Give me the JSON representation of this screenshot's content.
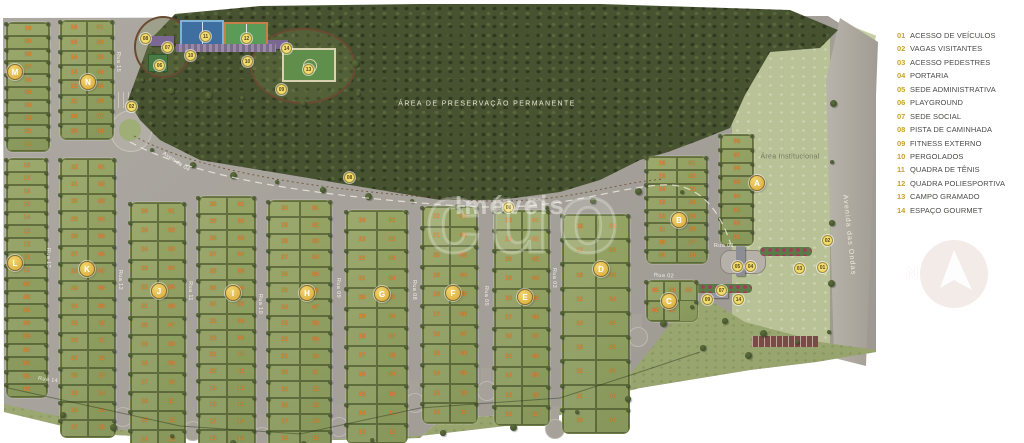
{
  "legend": {
    "items": [
      {
        "num": "01",
        "label": "ACESSO DE VEÍCULOS"
      },
      {
        "num": "02",
        "label": "VAGAS VISITANTES"
      },
      {
        "num": "03",
        "label": "ACESSO PEDESTRES"
      },
      {
        "num": "04",
        "label": "PORTARIA"
      },
      {
        "num": "05",
        "label": "SEDE ADMINISTRATIVA"
      },
      {
        "num": "06",
        "label": "PLAYGROUND"
      },
      {
        "num": "07",
        "label": "SEDE SOCIAL"
      },
      {
        "num": "08",
        "label": "PISTA DE CAMINHADA"
      },
      {
        "num": "09",
        "label": "FITNESS EXTERNO"
      },
      {
        "num": "10",
        "label": "PERGOLADOS"
      },
      {
        "num": "11",
        "label": "QUADRA DE TÊNIS"
      },
      {
        "num": "12",
        "label": "QUADRA POLIESPORTIVA"
      },
      {
        "num": "13",
        "label": "CAMPO GRAMADO"
      },
      {
        "num": "14",
        "label": "ESPAÇO GOURMET"
      }
    ]
  },
  "map": {
    "areas": {
      "preservation": "ÁREA DE PRESERVAÇÃO PERMANENTE",
      "institutional": "Área Institucional"
    },
    "streets": [
      {
        "name": "Avenida das Ondas",
        "x": 849,
        "y": 235,
        "rot": 84,
        "size": "lg"
      },
      {
        "name": "Avenida 04",
        "x": 176,
        "y": 162,
        "rot": 33,
        "size": "sm"
      },
      {
        "name": "Rua 01",
        "x": 724,
        "y": 246,
        "rot": 0,
        "size": "sm"
      },
      {
        "name": "Rua 02",
        "x": 664,
        "y": 276,
        "rot": 3,
        "size": "sm"
      },
      {
        "name": "Rua 03",
        "x": 554,
        "y": 278,
        "rot": 90,
        "size": "sm"
      },
      {
        "name": "Rua 05",
        "x": 486,
        "y": 296,
        "rot": 90,
        "size": "sm"
      },
      {
        "name": "Rua 08",
        "x": 414,
        "y": 290,
        "rot": 90,
        "size": "sm"
      },
      {
        "name": "Rua 09",
        "x": 338,
        "y": 288,
        "rot": 90,
        "size": "sm"
      },
      {
        "name": "Rua 10",
        "x": 260,
        "y": 304,
        "rot": 90,
        "size": "sm"
      },
      {
        "name": "Rua 11",
        "x": 190,
        "y": 291,
        "rot": 90,
        "size": "sm"
      },
      {
        "name": "Rua 12",
        "x": 120,
        "y": 280,
        "rot": 90,
        "size": "sm"
      },
      {
        "name": "Rua 13",
        "x": 48,
        "y": 258,
        "rot": 90,
        "size": "sm"
      },
      {
        "name": "Rua 14",
        "x": 48,
        "y": 380,
        "rot": 8,
        "size": "sm"
      },
      {
        "name": "Rua 15",
        "x": 118,
        "y": 62,
        "rot": 90,
        "size": "sm"
      }
    ],
    "blocks": [
      {
        "letter": "M",
        "x": 6,
        "y": 22,
        "w": 42,
        "h": 128,
        "cols": 1,
        "lots": 10,
        "bx": 14,
        "by": 71
      },
      {
        "letter": "N",
        "x": 60,
        "y": 20,
        "w": 52,
        "h": 118,
        "cols": 2,
        "lots": 16,
        "bx": 87,
        "by": 81
      },
      {
        "letter": "L",
        "x": 6,
        "y": 158,
        "w": 40,
        "h": 238,
        "cols": 1,
        "lots": 18,
        "bx": 14,
        "by": 262
      },
      {
        "letter": "K",
        "x": 60,
        "y": 158,
        "w": 54,
        "h": 278,
        "cols": 2,
        "lots": 32,
        "bx": 86,
        "by": 268
      },
      {
        "letter": "J",
        "x": 130,
        "y": 202,
        "w": 54,
        "h": 246,
        "cols": 2,
        "lots": 26,
        "bx": 158,
        "by": 290
      },
      {
        "letter": "I",
        "x": 198,
        "y": 196,
        "w": 56,
        "h": 250,
        "cols": 2,
        "lots": 30,
        "bx": 232,
        "by": 292
      },
      {
        "letter": "H",
        "x": 268,
        "y": 200,
        "w": 62,
        "h": 246,
        "cols": 2,
        "lots": 30,
        "bx": 306,
        "by": 292
      },
      {
        "letter": "G",
        "x": 346,
        "y": 210,
        "w": 60,
        "h": 232,
        "cols": 2,
        "lots": 24,
        "bx": 381,
        "by": 293
      },
      {
        "letter": "F",
        "x": 422,
        "y": 206,
        "w": 54,
        "h": 216,
        "cols": 2,
        "lots": 22,
        "bx": 452,
        "by": 292
      },
      {
        "letter": "E",
        "x": 494,
        "y": 210,
        "w": 54,
        "h": 214,
        "cols": 2,
        "lots": 22,
        "bx": 524,
        "by": 296
      },
      {
        "letter": "D",
        "x": 562,
        "y": 214,
        "w": 66,
        "h": 218,
        "cols": 2,
        "lots": 18,
        "bx": 600,
        "by": 268
      },
      {
        "letter": "C",
        "x": 646,
        "y": 280,
        "w": 50,
        "h": 40,
        "cols": 3,
        "lots": 5,
        "bx": 668,
        "by": 300
      },
      {
        "letter": "B",
        "x": 646,
        "y": 156,
        "w": 60,
        "h": 106,
        "cols": 2,
        "lots": 16,
        "bx": 678,
        "by": 219
      },
      {
        "letter": "A",
        "x": 720,
        "y": 134,
        "w": 32,
        "h": 110,
        "cols": 1,
        "lots": 8,
        "bx": 756,
        "by": 182
      }
    ],
    "markers": [
      {
        "num": "08",
        "x": 140,
        "y": 33
      },
      {
        "num": "07",
        "x": 162,
        "y": 42
      },
      {
        "num": "06",
        "x": 154,
        "y": 60
      },
      {
        "num": "10",
        "x": 185,
        "y": 50
      },
      {
        "num": "11",
        "x": 200,
        "y": 31
      },
      {
        "num": "12",
        "x": 241,
        "y": 33
      },
      {
        "num": "10",
        "x": 242,
        "y": 56
      },
      {
        "num": "14",
        "x": 281,
        "y": 43
      },
      {
        "num": "13",
        "x": 303,
        "y": 64
      },
      {
        "num": "09",
        "x": 276,
        "y": 84
      },
      {
        "num": "08",
        "x": 344,
        "y": 172
      },
      {
        "num": "08",
        "x": 503,
        "y": 202
      },
      {
        "num": "02",
        "x": 126,
        "y": 101
      },
      {
        "num": "02",
        "x": 822,
        "y": 235
      },
      {
        "num": "05",
        "x": 732,
        "y": 261
      },
      {
        "num": "04",
        "x": 745,
        "y": 261
      },
      {
        "num": "03",
        "x": 794,
        "y": 263
      },
      {
        "num": "01",
        "x": 817,
        "y": 262
      },
      {
        "num": "07",
        "x": 716,
        "y": 285
      },
      {
        "num": "14",
        "x": 733,
        "y": 294
      },
      {
        "num": "09",
        "x": 702,
        "y": 294
      }
    ],
    "watermark": {
      "name": "Imóveis",
      "logo": "cuo"
    },
    "compass": {
      "label": "N"
    }
  },
  "colors": {
    "road": "#a6a29a",
    "grass": "#a3ad7c",
    "forest": "#475231",
    "block_green": "#8e9e60",
    "lot_number": "#e0832f",
    "badge_gold": "#d8a93c",
    "marker_gold": "#f1dc6e",
    "institutional": "#b9c296",
    "legend_number": "#c9a227",
    "legend_text": "#4a4a48"
  }
}
